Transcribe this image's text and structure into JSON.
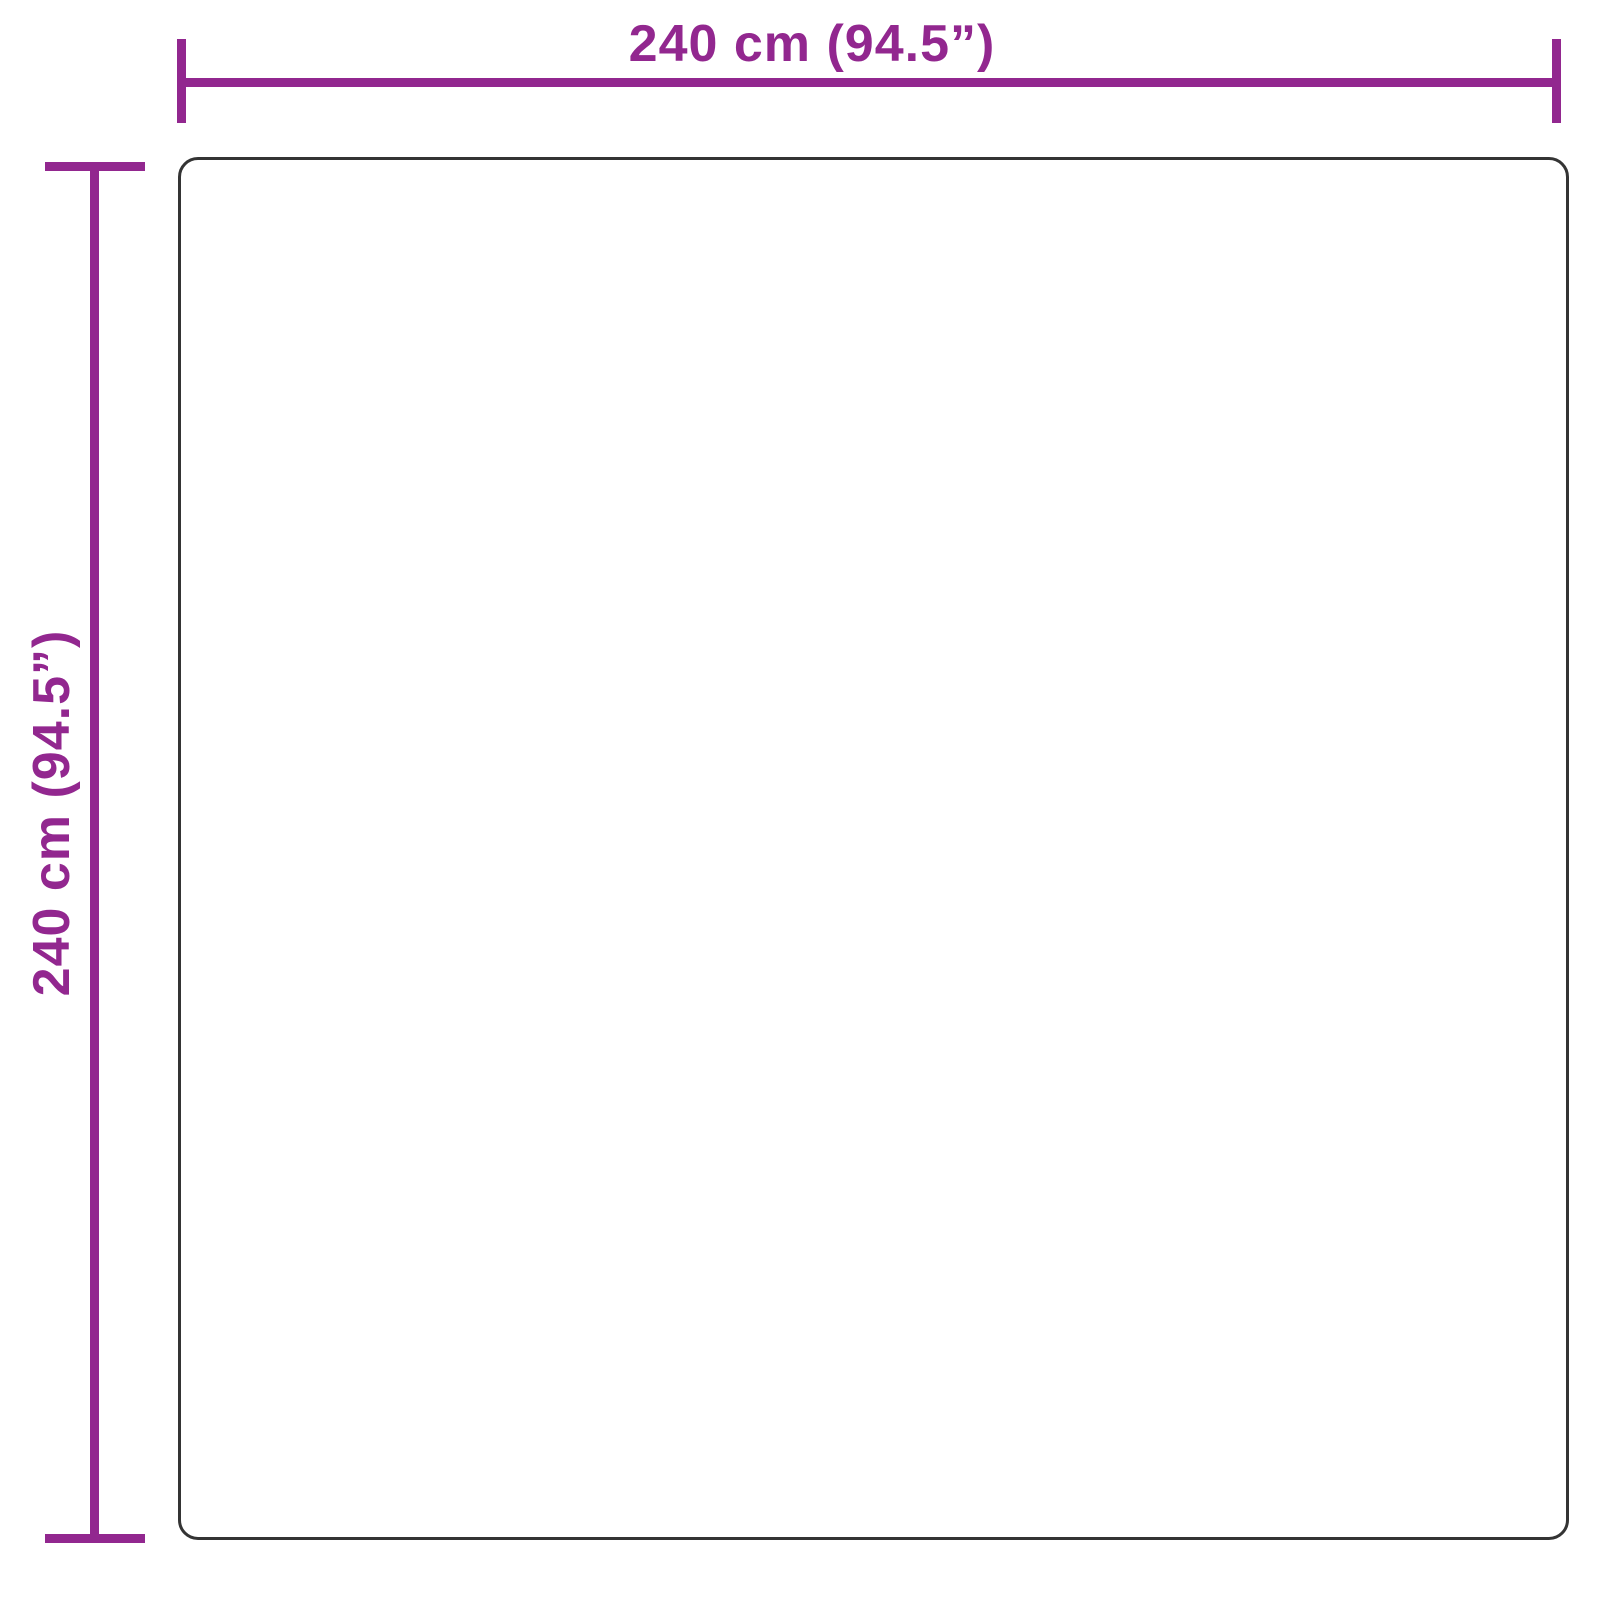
{
  "diagram": {
    "type": "product-dimension-diagram",
    "shape": "square",
    "width_dimension": {
      "label": "240 cm (94.5”)",
      "position": "top"
    },
    "height_dimension": {
      "label": "240 cm (94.5”)",
      "position": "left"
    }
  },
  "colors": {
    "dimension-line": "#92278F",
    "outline": "#343434",
    "background": "#FFFFFF"
  }
}
